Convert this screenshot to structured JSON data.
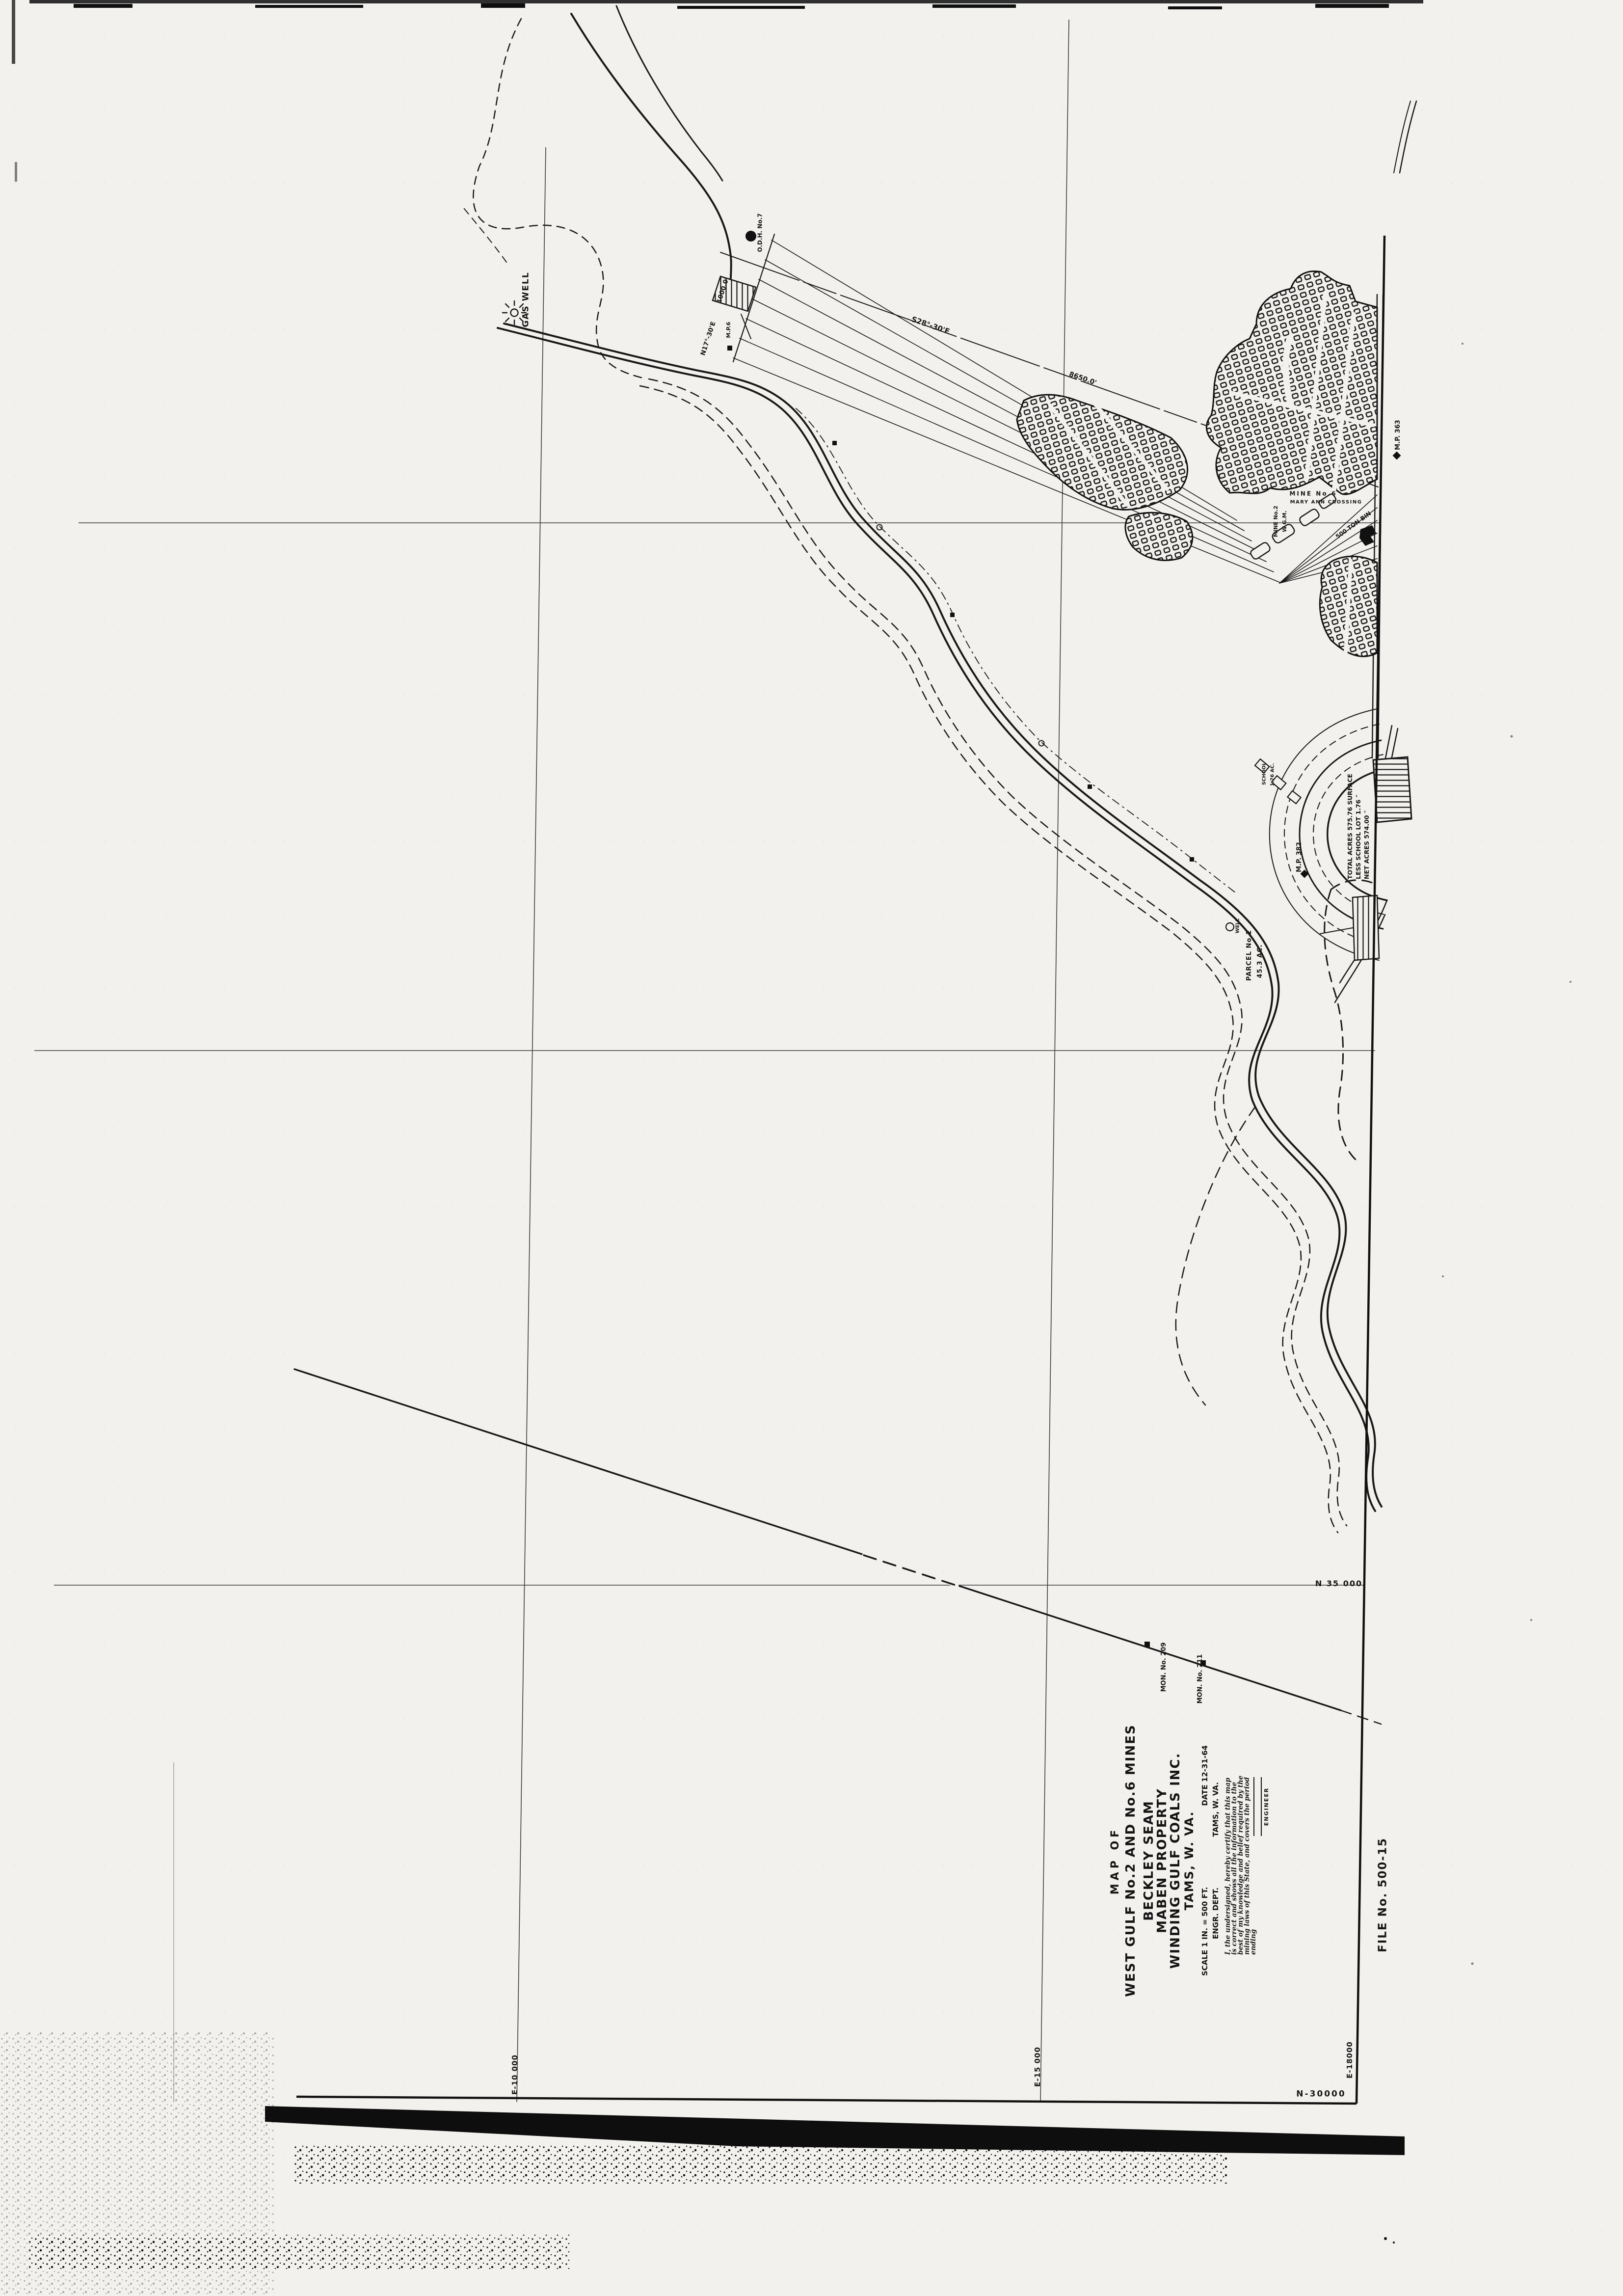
{
  "sheet": {
    "file_no": "FILE No. 500-15"
  },
  "title_block": {
    "line1": "MAP OF",
    "line2": "WEST GULF No.2 AND No.6 MINES",
    "line3": "BECKLEY SEAM",
    "line4": "MABEN PROPERTY",
    "line5": "WINDING GULF COALS INC.",
    "line6": "TAMS, W. VA.",
    "scale_label": "SCALE  1 IN. = 500 FT.",
    "date_label": "DATE 12-31-64",
    "dept_label": "ENGR. DEPT.",
    "dept_location": "TAMS, W. VA.",
    "certification": [
      "I, the undersigned, hereby certify that this map",
      "is correct and shows all the information to the",
      "best of my knowledge and belief required by the",
      "mining laws of this State, and covers the period",
      "ending"
    ],
    "engineer_label": "ENGINEER"
  },
  "grid": {
    "e10": "E-10 000",
    "e15": "E-15 000",
    "e18": "E-18000",
    "n35": "N 35 000",
    "n30": "N-30000"
  },
  "map_labels": {
    "gas_well": "GAS WELL",
    "odh": "O.D.H. No.7",
    "n17_bearing": "N17°-30'E",
    "n17_distance": "1000.0'",
    "mp6": "M.P.6",
    "s28_bearing": "S28°-30'E",
    "dist_8650": "8650.0'",
    "mine6": "MINE No.6",
    "crossing": "MARY ANN CROSSING",
    "mine2": "MINE No.2",
    "wgm": "W.G.M.",
    "bin": "500 TON BIN",
    "mp363": "M.P. 363",
    "mp382": "M.P. 382",
    "acreage": [
      "TOTAL ACRES 575.76 SURFACE",
      "LESS SCHOOL LOT 1.76 ″",
      "NET ACRES 574.00 ″"
    ],
    "school": "SCHOOL",
    "school_area": "1.76 AC.",
    "parcel": "PARCEL No.2",
    "parcel_area": "45.3 AC.",
    "well": "WELL",
    "mon209": "MON. No. 209",
    "mon211": "MON. No. 211"
  }
}
